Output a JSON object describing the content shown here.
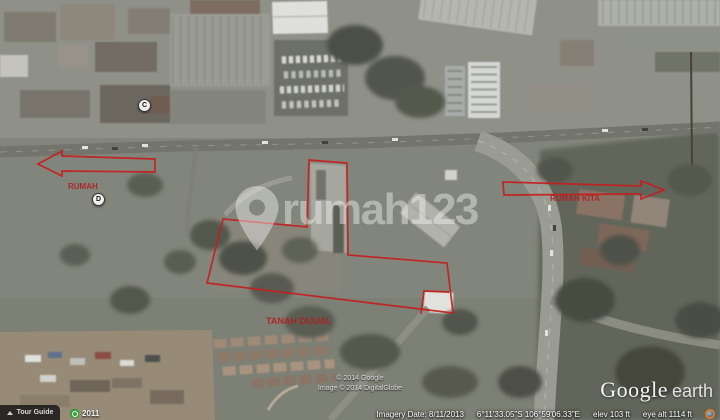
{
  "watermark": {
    "brand": "rumah123"
  },
  "logo": {
    "google": "Google",
    "earth": "earth"
  },
  "toolbar": {
    "tour_guide_label": "Tour Guide",
    "history_year": "2011"
  },
  "status_bar": {
    "imagery_date": "Imagery Date: 8/11/2013",
    "coordinates": "6°11'33.05\"S 106°59'06.33\"E",
    "elevation": "elev 103 ft",
    "eye_altitude": "eye alt 1114 ft"
  },
  "attribution": {
    "line1": "© 2014 Google",
    "line2": "Image © 2014 DigitalGlobe"
  },
  "placemarks": [
    {
      "label": "C"
    },
    {
      "label": "D"
    }
  ],
  "annotations": {
    "color": "#c41e1e",
    "main_polygon_points": "309,160 347,163 348,255 447,263 453,313 207,283 223,219 307,227",
    "notch_points": "449,292 424,291 421,314",
    "right_arrow_points": "503,182 641,186 641,181 664,190 641,199 641,194 504,195",
    "left_arrow_points": "155,159 62,156 62,151 38,164 62,176 62,171 155,172",
    "labels": [
      {
        "text": "RUMAH"
      },
      {
        "text": "RUMAH KITA"
      },
      {
        "text": "TANAH DIJUAL"
      }
    ]
  }
}
